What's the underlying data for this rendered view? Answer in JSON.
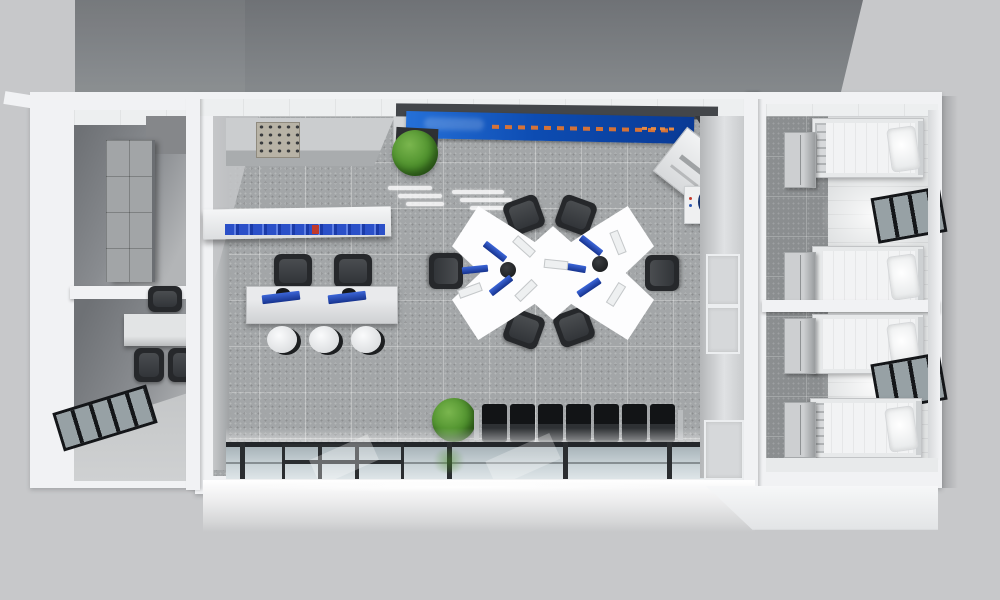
{
  "scene": {
    "title": "Top-down 3D rendering of a modular container office building",
    "view": "bird's-eye cutaway showing interior furnishing",
    "display_screen": {
      "color": "blue",
      "content": "orange lettering, not legible"
    }
  },
  "palette": {
    "ground": "#c7c8ca",
    "backdrop_dark": "#76797d",
    "walls_white": "#f1f2f4",
    "office_floor": "#a3a6a8",
    "corridor_floor": "#8b8e90",
    "dorm_floor": "#e0e2e3",
    "screen_blue": "#0d4cb2",
    "screen_text_orange": "#e6762e",
    "plant_green": "#4c8f2b",
    "chair_black": "#26282b",
    "desk_white": "#fdfdfe",
    "glass_facade": "#c3ced3",
    "bed_linen": "#f2f3f4"
  },
  "modules": {
    "left": {
      "name": "utility module",
      "rooms": [
        {
          "name": "storage room",
          "items": [
            "tall shelving cabinet"
          ]
        },
        {
          "name": "small office",
          "items": [
            "wall desk",
            "3 office chairs",
            "strip window"
          ]
        }
      ]
    },
    "center": {
      "name": "main office hall",
      "items": [
        "wall counter with control panel",
        "wall-mounted blue display screen",
        "potted plant",
        "office printer",
        "water cooler with blue bottle",
        "display shelf with blue binders",
        "reception counter with 2 monitors",
        "2 task chairs at reception",
        "3 round stools",
        "x-shaped workstation desk with 6 seats",
        "6 monitors and keyboards",
        "row of 7 waiting seats",
        "potted plant at waiting area",
        "glazed front facade with framed door"
      ]
    },
    "right": {
      "name": "dormitory module",
      "rooms": [
        {
          "name": "dorm room 1",
          "items": [
            "2 single beds with pillows",
            "2 lockers",
            "strip window"
          ]
        },
        {
          "name": "dorm room 2",
          "items": [
            "2 single beds with pillows",
            "2 lockers",
            "strip window"
          ]
        }
      ]
    }
  },
  "counts": {
    "beds": 4,
    "lockers": 4,
    "waiting_seats": 7,
    "workstation_chairs": 6,
    "stools": 3,
    "reception_monitors": 2,
    "plants": 2,
    "dorm_windows": 2
  }
}
